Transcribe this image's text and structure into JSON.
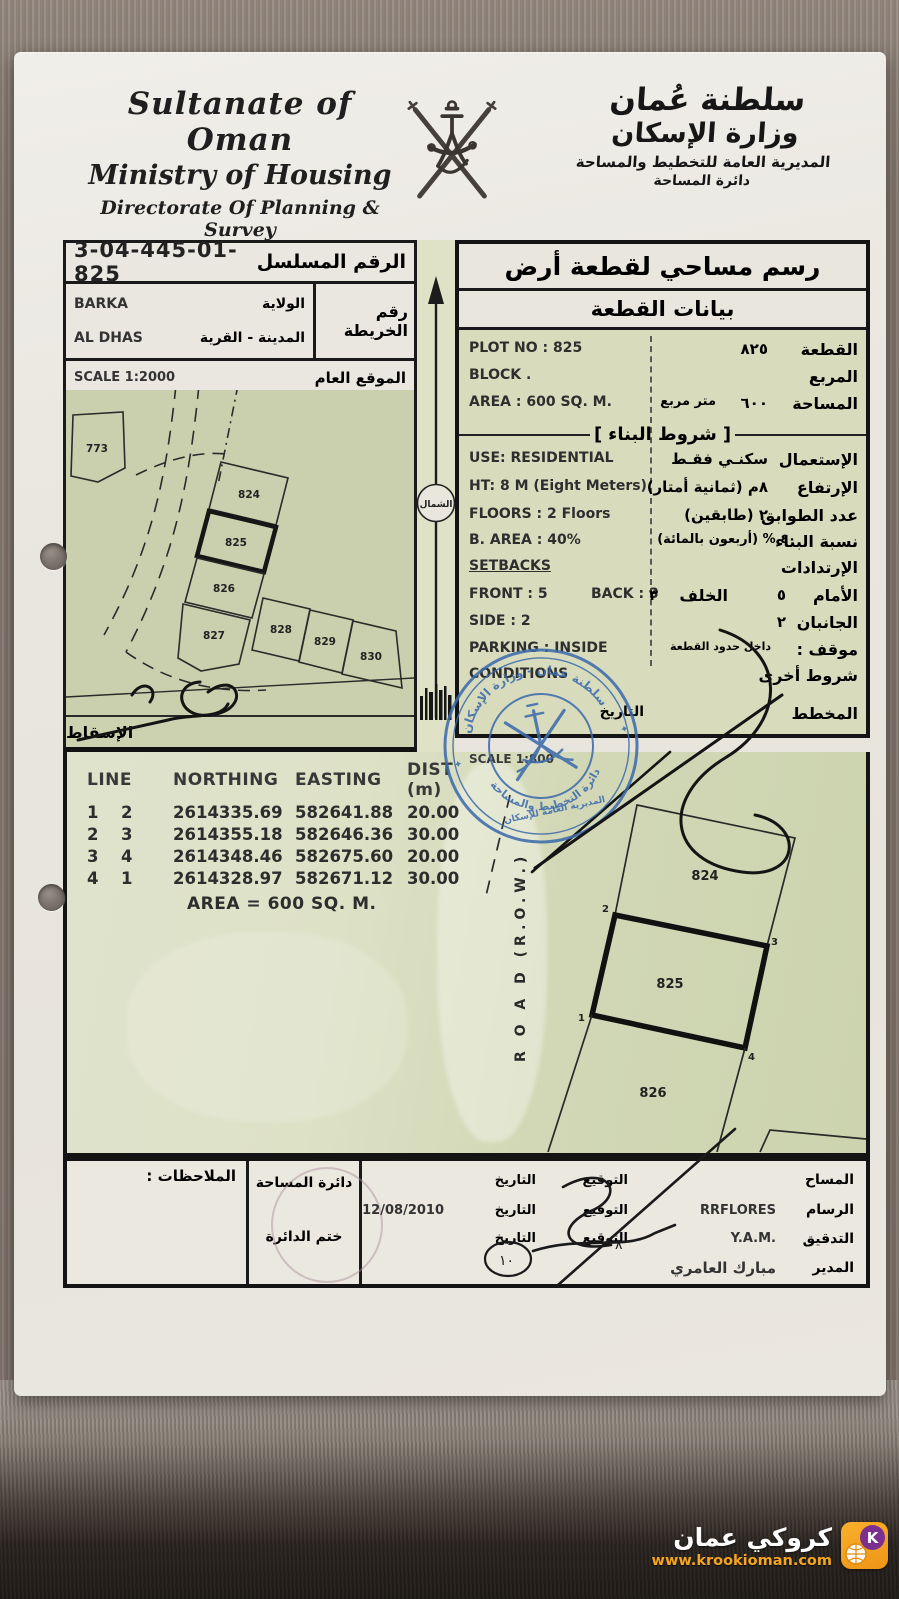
{
  "header": {
    "en_line1": "Sultanate of Oman",
    "en_line2": "Ministry of Housing",
    "en_line3": "Directorate Of Planning & Survey",
    "en_line4": "Survey Department",
    "ar_line1": "سلطنة عُمان",
    "ar_line2": "وزارة الإسكان",
    "ar_line3": "المديرية العامة للتخطيط والمساحة",
    "ar_line4": "دائرة المساحة"
  },
  "serial": {
    "value": "3-04-445-01-825",
    "label_ar": "الرقم المسلسل"
  },
  "map_info": {
    "wilayat_value": "BARKA",
    "wilayat_label_ar": "الولاية",
    "town_value": "AL DHAS",
    "town_label_ar": "المدينة - القرية",
    "map_no_label_ar": "رقم الخريطة",
    "scale": "SCALE 1:2000",
    "location_label_ar": "الموقع العام",
    "projection_label_ar": "الإسقاط",
    "north_label_ar": "الشمال",
    "plots": [
      "773",
      "824",
      "825",
      "826",
      "827",
      "828",
      "829",
      "830"
    ]
  },
  "title_block": {
    "title_ar": "رسم مساحي لقطعة أرض",
    "subtitle_ar": "بيانات القطعة"
  },
  "plot_data": {
    "plot_no_en": "PLOT NO : 825",
    "plot_no_ar_value": "٨٢٥",
    "plot_no_label_ar": "القطعة",
    "block_en": "BLOCK .",
    "block_label_ar": "المربع",
    "area_en": "AREA :  600 SQ. M.",
    "area_ar_value": "٦٠٠",
    "area_ar_unit": "متر مربع",
    "area_label_ar": "المساحة"
  },
  "building_conditions": {
    "header_ar": "شروط البناء",
    "use_en": "USE: RESIDENTIAL",
    "use_ar_value": "سكنـي فقـط",
    "use_label_ar": "الإستعمال",
    "ht_en": "HT: 8 M  (Eight Meters)",
    "ht_ar_value": "٨م  (ثمانية أمتار)",
    "ht_label_ar": "الإرتفاع",
    "floors_en": "FLOORS : 2 Floors",
    "floors_ar_value": "٢  (طابقين)",
    "floors_label_ar": "عدد الطوابق",
    "barea_en": "B. AREA :   40%",
    "barea_ar_value": "٤٠ % (أربعون بالمائة)",
    "barea_label_ar": "نسبة البناء",
    "setbacks_en": "SETBACKS",
    "setbacks_label_ar": "الإرتدادات",
    "front_en": "FRONT : 5",
    "back_en": "BACK : 3",
    "front_label_ar": "الأمام",
    "front_ar_value": "٥",
    "back_label_ar": "الخلف",
    "back_ar_value": "٣",
    "side_en": "SIDE :   2",
    "side_label_ar": "الجانبان",
    "side_ar_value": "٢",
    "parking_en": "PARKING : INSIDE",
    "parking_label_ar": "موقف :",
    "parking_ar_value": "داخل حدود القطعة",
    "conditions_en": "CONDITIONS",
    "conditions_label_ar": "شروط أخرى",
    "planner_label_ar": "المخطط",
    "date_label_ar": "التاريخ"
  },
  "survey_table": {
    "scale": "SCALE 1:800",
    "headers": [
      "LINE",
      "NORTHING",
      "EASTING",
      "DIST (m)"
    ],
    "rows": [
      [
        "1",
        "2",
        "2614335.69",
        "582641.88",
        "20.00"
      ],
      [
        "2",
        "3",
        "2614355.18",
        "582646.36",
        "30.00"
      ],
      [
        "3",
        "4",
        "2614348.46",
        "582675.60",
        "20.00"
      ],
      [
        "4",
        "1",
        "2614328.97",
        "582671.12",
        "30.00"
      ]
    ],
    "area_total": "AREA = 600 SQ. M.",
    "road_label": "R O A D   (R.O.W.)",
    "detail_plots": [
      "824",
      "825",
      "826"
    ],
    "corner_labels": [
      "1",
      "2",
      "3",
      "4"
    ]
  },
  "stamp": {
    "arc_top_ar": "سلطنة عمان - وزارة الإسكان",
    "arc_bottom_ar": "دائرة التخطيط والمساحة",
    "inner_ar": "المديرية العامة للإسكان"
  },
  "footer": {
    "notes_label_ar": "الملاحظات :",
    "dept_label_ar": "دائرة المساحة",
    "dept_stamp_label_ar": "ختم الدائرة",
    "rows": [
      {
        "role": "المساح",
        "name": "",
        "sig_label": "التوقيع",
        "date_label": "التاريخ",
        "date_value": ""
      },
      {
        "role": "الرسام",
        "name": "RRFLORES",
        "sig_label": "التوقيع",
        "date_label": "التاريخ",
        "date_value": "12/08/2010"
      },
      {
        "role": "التدقيق",
        "name": "Y.A.M.",
        "sig_label": "التوقيع",
        "date_label": "التاريخ",
        "date_value": ""
      },
      {
        "role": "المدير",
        "name_ar": "مبارك العامري"
      }
    ]
  },
  "watermark": {
    "title_ar": "كروكي عمان",
    "url": "www.krookioman.com",
    "icon_letter": "K"
  },
  "colors": {
    "stamp_blue": "#3e6cab",
    "watermark_orange": "#f6a51f",
    "map_green": "#cad0ad"
  }
}
